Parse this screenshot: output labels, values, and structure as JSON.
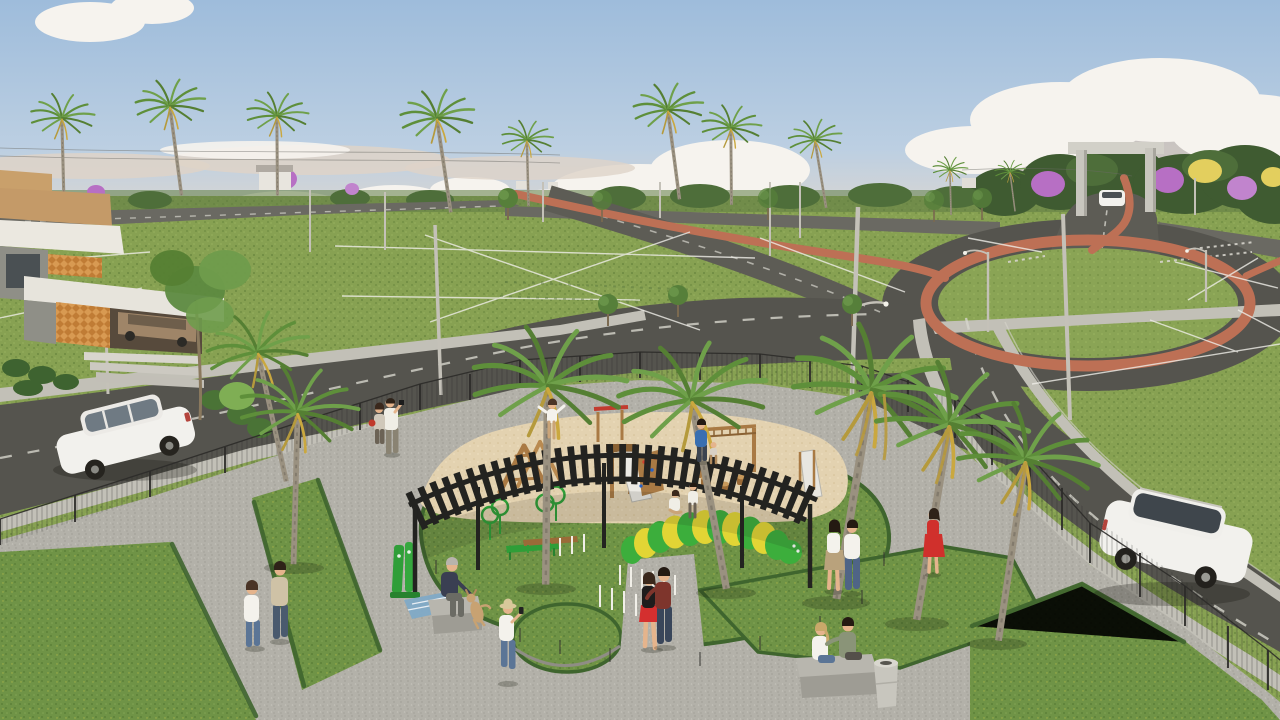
{
  "scene": {
    "title": "Aerial 3D render of a residential land development with central dog park and playground",
    "time_of_day": "late afternoon, warm hazy light",
    "palette": {
      "sky_top": "#9ebcdb",
      "sky_mid": "#bccfe2",
      "sky_horizon": "#e6d9cb",
      "cloud": "#f6f3ee",
      "cloud_shade": "#cdc2b9",
      "haze_band": "#ded3c8",
      "treeline": "#53703d",
      "forest_dark": "#3f5b31",
      "grass_field": "#87a152",
      "grass_field_fleck": "#6d8a41",
      "grass_park": "#6f9346",
      "grass_park_dark": "#5c8039",
      "grass_island": "#8aa455",
      "road": "#55544e",
      "road_far": "#6a6962",
      "lane_marking": "#d6d4cc",
      "bike_path": "#bd7055",
      "sidewalk": "#c2c0b7",
      "paver": "#b3b1a9",
      "sand": "#e3d2b0",
      "sand_shade": "#d4c096",
      "wood": "#a97a44",
      "wood_dark": "#8a6234",
      "pergola": "#232320",
      "fence": "#2c2b29",
      "house_white": "#ebe8e0",
      "house_tan": "#c9a06b",
      "house_orange": "#d89a52",
      "house_grey": "#8f8f87",
      "glass_dark": "#4b5053",
      "car_white": "#f2f1ed",
      "caterpillar_green": "#3cae3c",
      "caterpillar_yellow": "#e2d535",
      "equipment_green": "#2f9e38",
      "flower_purple": "#b76fc4",
      "flower_yellow": "#e3cf5e",
      "skin": "#e5b48c",
      "concrete": "#b8b6ae"
    },
    "landmarks": {
      "entrance_portal": "concrete gate frame over entry road with white car passing",
      "roundabout": "oval grass island ringed by terracotta bike lane",
      "model_house": "modern flat-roof house with tan slabs and orange cobogo panels, carport with bronze car",
      "dog_park": "fenced plaza with black curved pergola, sand playground, agility lawn, caterpillar tunnel"
    },
    "vehicles": [
      {
        "name": "white-hatchback",
        "location": "left street",
        "color": "white"
      },
      {
        "name": "white-suv",
        "location": "right street",
        "color": "white"
      },
      {
        "name": "bronze-car",
        "location": "house carport",
        "color": "bronze"
      },
      {
        "name": "distant-white-car",
        "location": "under entrance portal",
        "color": "white"
      }
    ],
    "vegetation": {
      "horizon_palms": 8,
      "park_palms": 7,
      "flowering_trees": "purple and yellow ipe clusters near entrance and left field",
      "small_trees": 12,
      "hedges": "low hedge strips edging park lawns"
    },
    "park_facilities": [
      "curved black steel pergola",
      "sand pit with log climbers, slides, red-top frame, climbing wall, monkey bars, wooden stools",
      "dog agility lawn with green hoop jumps, weave poles, balance beam, green bench",
      "green and yellow caterpillar tunnel",
      "outdoor exercise station",
      "two concrete benches and litter bin",
      "wire mesh perimeter fence"
    ],
    "people": [
      {
        "name": "walking-woman",
        "outfit": "white top, jeans"
      },
      {
        "name": "walking-man",
        "outfit": "beige shirt, dark trousers"
      },
      {
        "name": "hat-phone-woman",
        "outfit": "straw hat, white top, jeans"
      },
      {
        "name": "old-man-on-bench",
        "outfit": "navy jacket",
        "with": "tan dog"
      },
      {
        "name": "embracing-woman",
        "outfit": "black top, red skirt"
      },
      {
        "name": "embracing-man",
        "outfit": "dark red shirt, jeans"
      },
      {
        "name": "talking-woman",
        "outfit": "white top, tan skirt"
      },
      {
        "name": "talking-man",
        "outfit": "white shirt, jeans"
      },
      {
        "name": "red-dress-woman",
        "outfit": "red dress"
      },
      {
        "name": "bench-couple-woman",
        "outfit": "white top"
      },
      {
        "name": "bench-couple-man",
        "outfit": "sage shirt"
      },
      {
        "name": "photographer",
        "outfit": "white shirt, khaki pants, raised camera"
      },
      {
        "name": "companion-red-bag",
        "outfit": "light top, red shoulder bag"
      },
      {
        "name": "dad-blue-shirt",
        "outfit": "blue shirt",
        "with": "toddler"
      },
      {
        "name": "kid-on-climber",
        "outfit": "white shirt"
      },
      {
        "name": "sand-sitting-woman",
        "outfit": "white"
      },
      {
        "name": "sand-standing-man",
        "outfit": "white"
      }
    ]
  }
}
